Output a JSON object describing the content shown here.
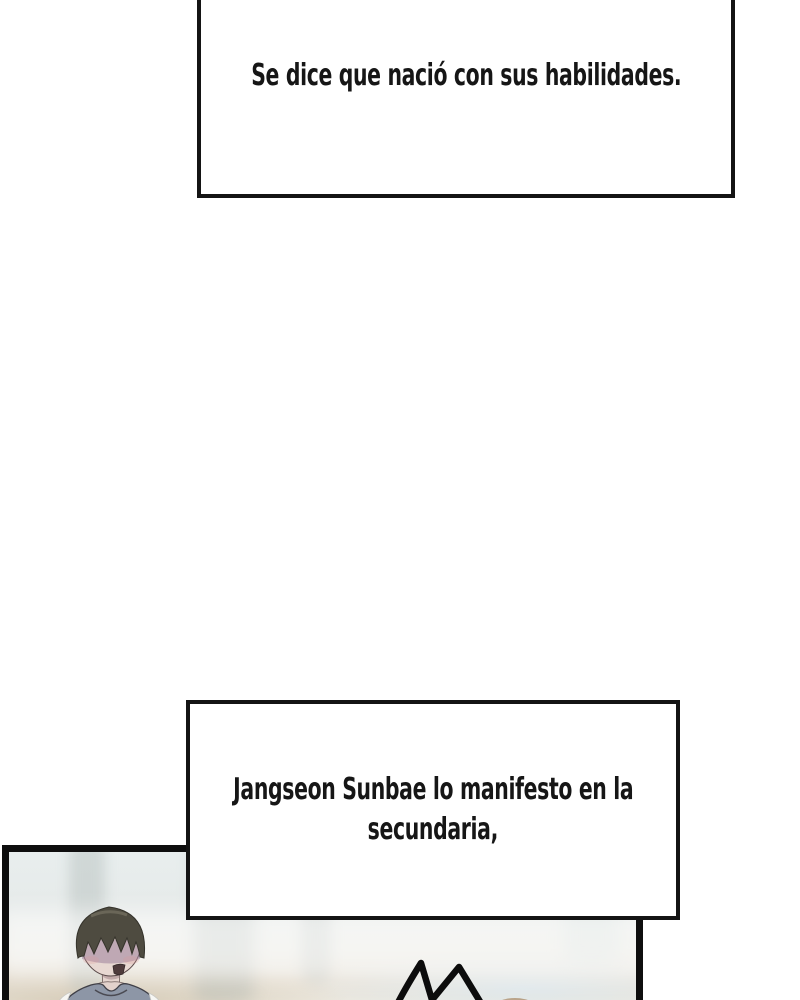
{
  "page": {
    "kind": "webtoon comic page segment",
    "background_color": "#ffffff"
  },
  "captions": [
    {
      "text": "Se dice que nació con sus habilidades."
    },
    {
      "lines": [
        "Jangseon Sunbae lo manifesto en la",
        "secundaria,"
      ]
    }
  ],
  "panel": {
    "border_color": "#0e0e0e",
    "background_tints": [
      "#e8eeee",
      "#e9e9e3",
      "#d8cfc2",
      "#e6edf1"
    ],
    "character": {
      "hair_color": "#4e4b40",
      "skin_color": "#e8d8d2",
      "face_shadow_color": "#a592a4",
      "vest_color": "#8d96a6",
      "shirt_color": "#f6f6f3",
      "expression": "open-mouth distressed"
    },
    "effects": {
      "spike_line_color": "#0c0c0c",
      "second_character_hair_color": "#ac957c"
    }
  }
}
